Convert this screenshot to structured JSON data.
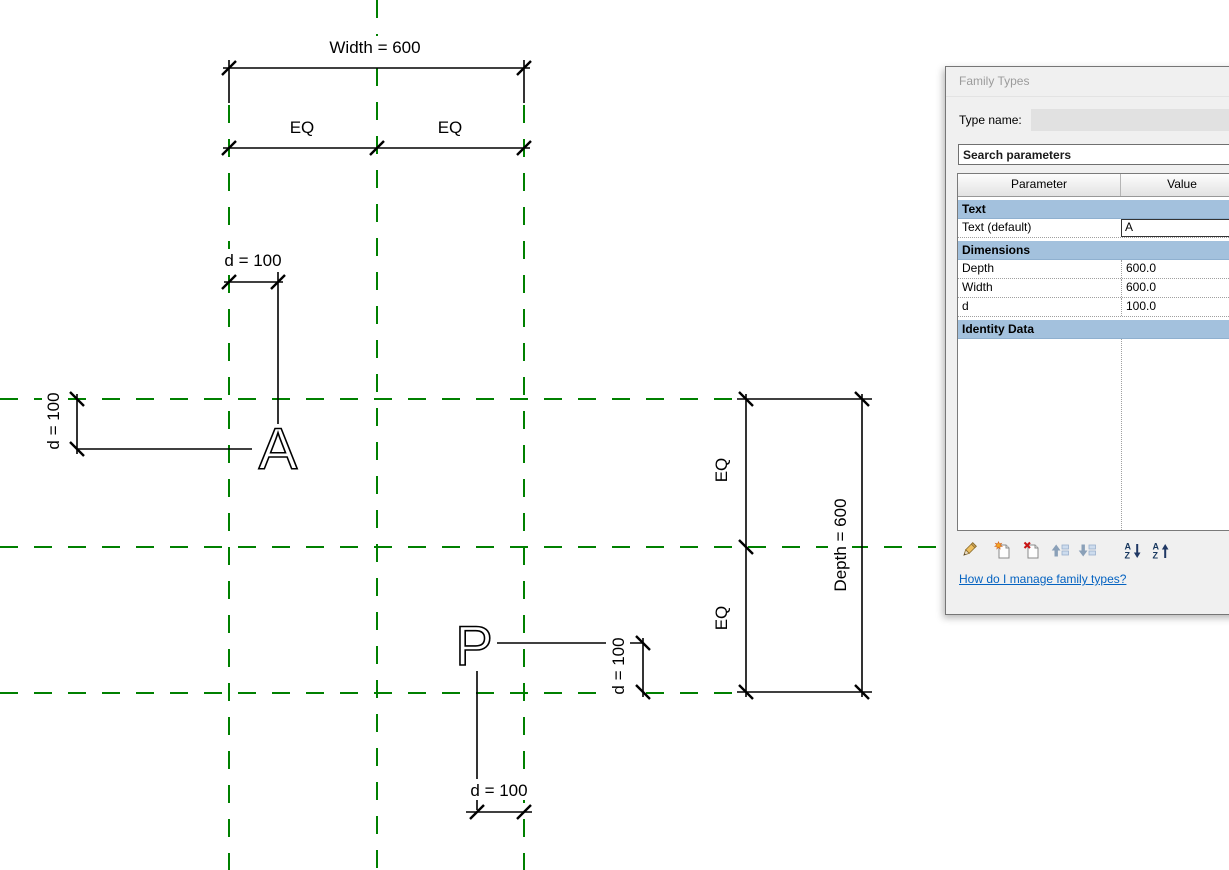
{
  "drawing": {
    "colors": {
      "ref_plane": "#008000",
      "line": "#000000"
    },
    "texts": {
      "width_dim": "Width = 600",
      "eq_top_left": "EQ",
      "eq_top_right": "EQ",
      "d_top": "d = 100",
      "d_left": "d = 100",
      "d_mid": "d = 100",
      "d_bottom": "d = 100",
      "eq_right_upper": "EQ",
      "eq_right_lower": "EQ",
      "depth_dim": "Depth = 600",
      "letter_a": "A",
      "letter_p": "P"
    }
  },
  "dialog": {
    "title": "Family Types",
    "type_name_label": "Type name:",
    "search_placeholder": "Search parameters",
    "table": {
      "columns": [
        "Parameter",
        "Value"
      ],
      "rows": [
        {
          "type": "category",
          "label": "Text"
        },
        {
          "type": "param",
          "label": "Text (default)",
          "value": "A",
          "editing": true
        },
        {
          "type": "category",
          "label": "Dimensions"
        },
        {
          "type": "param",
          "label": "Depth",
          "value": "600.0"
        },
        {
          "type": "param",
          "label": "Width",
          "value": "600.0"
        },
        {
          "type": "param",
          "label": "d",
          "value": "100.0"
        },
        {
          "type": "category",
          "label": "Identity Data"
        }
      ]
    },
    "toolbar_icons": [
      "edit-parameter",
      "new-parameter",
      "delete-parameter",
      "move-parameter-up",
      "move-parameter-down",
      "sort-ascending",
      "sort-descending"
    ],
    "help_link": "How do I manage family types?",
    "accent_category_color": "#a3c1dd",
    "link_color": "#0563c1"
  }
}
